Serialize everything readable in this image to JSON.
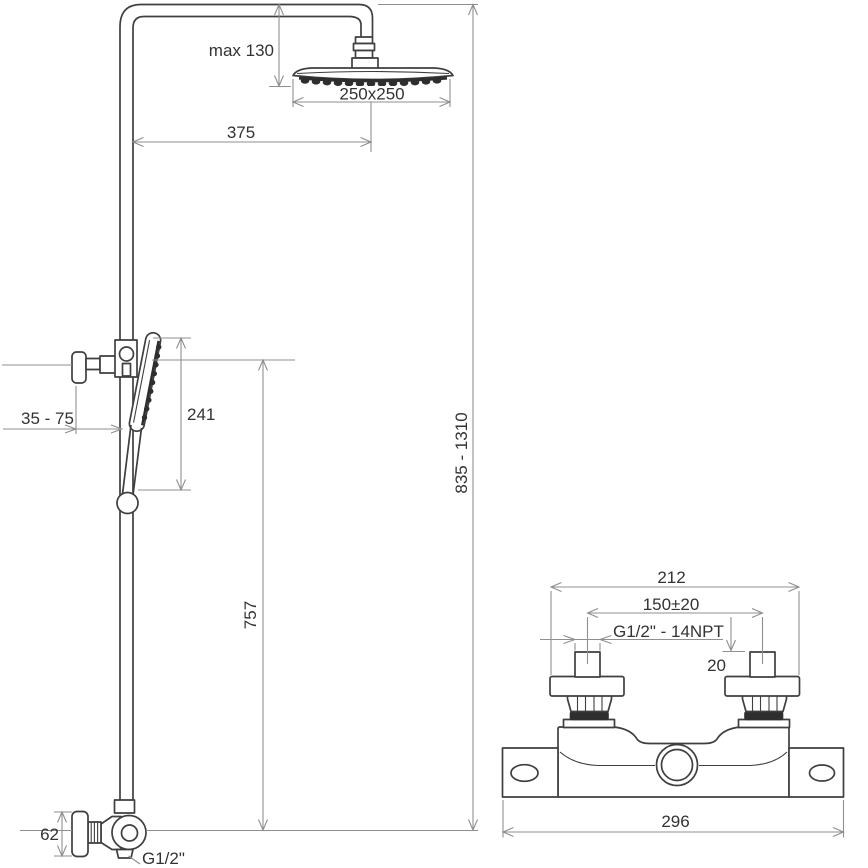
{
  "drawing": {
    "column": {
      "max130": "max 130",
      "head_size": "250x250",
      "offset": "375",
      "hand_shower_len": "241",
      "bracket_range": "35 - 75",
      "rail_lower": "757",
      "total_height": "835 - 1310",
      "outlet_height": "62",
      "outlet_thread": "G1/2\""
    },
    "mixer": {
      "flange_span": "212",
      "inlet_spacing": "150±20",
      "inlet_thread": "G1/2\" - 14NPT",
      "inlet_height": "20",
      "total_width": "296"
    },
    "colors": {
      "outline": "#3f3f3f",
      "dimension": "#8f8f8f",
      "text": "#333333",
      "background": "#ffffff"
    }
  }
}
